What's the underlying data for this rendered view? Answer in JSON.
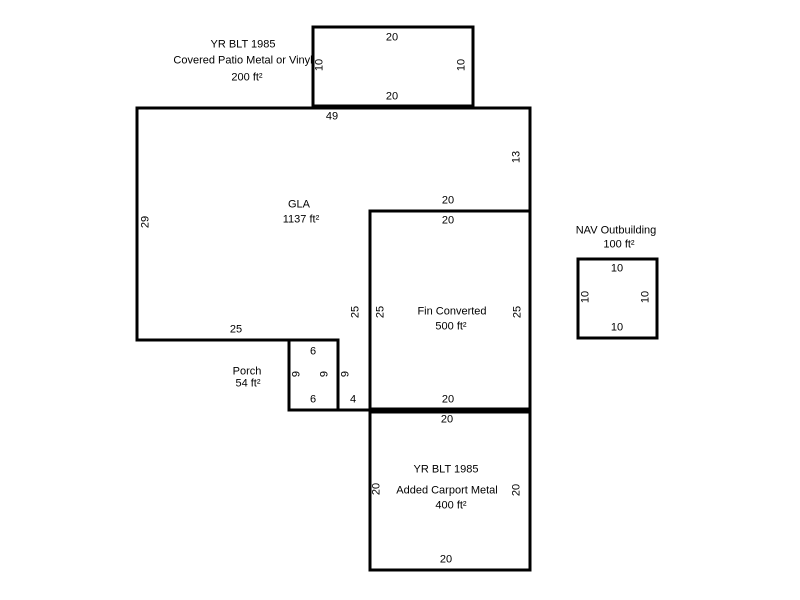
{
  "canvas": {
    "background_color": "#ffffff",
    "line_color": "#000000",
    "text_color": "#000000"
  },
  "buildings": {
    "covered_patio": {
      "year": "YR BLT 1985",
      "name": "Covered Patio Metal or Vinyl",
      "area": "200 ft²",
      "dims": {
        "top": "20",
        "left": "10",
        "right": "10",
        "bottom": "20"
      }
    },
    "gla": {
      "name": "GLA",
      "area": "1137 ft²",
      "dims": {
        "top": "49",
        "left": "29",
        "right": "13",
        "bottom": "25",
        "notch_top": "20",
        "notch_side": "25",
        "notch_bottom": "4",
        "porch_side": "9"
      }
    },
    "fin_converted": {
      "name": "Fin Converted",
      "area": "500 ft²",
      "dims": {
        "top": "20",
        "left": "25",
        "right": "25",
        "bottom": "20"
      }
    },
    "porch": {
      "name": "Porch",
      "area": "54 ft²",
      "dims": {
        "top": "6",
        "left": "9",
        "right": "9",
        "bottom": "6"
      }
    },
    "carport": {
      "year": "YR BLT 1985",
      "name": "Added Carport Metal",
      "area": "400 ft²",
      "dims": {
        "top": "20",
        "left": "20",
        "right": "20",
        "bottom": "20"
      }
    },
    "outbuilding": {
      "name": "NAV Outbuilding",
      "area": "100 ft²",
      "dims": {
        "top": "10",
        "left": "10",
        "right": "10",
        "bottom": "10"
      }
    }
  }
}
